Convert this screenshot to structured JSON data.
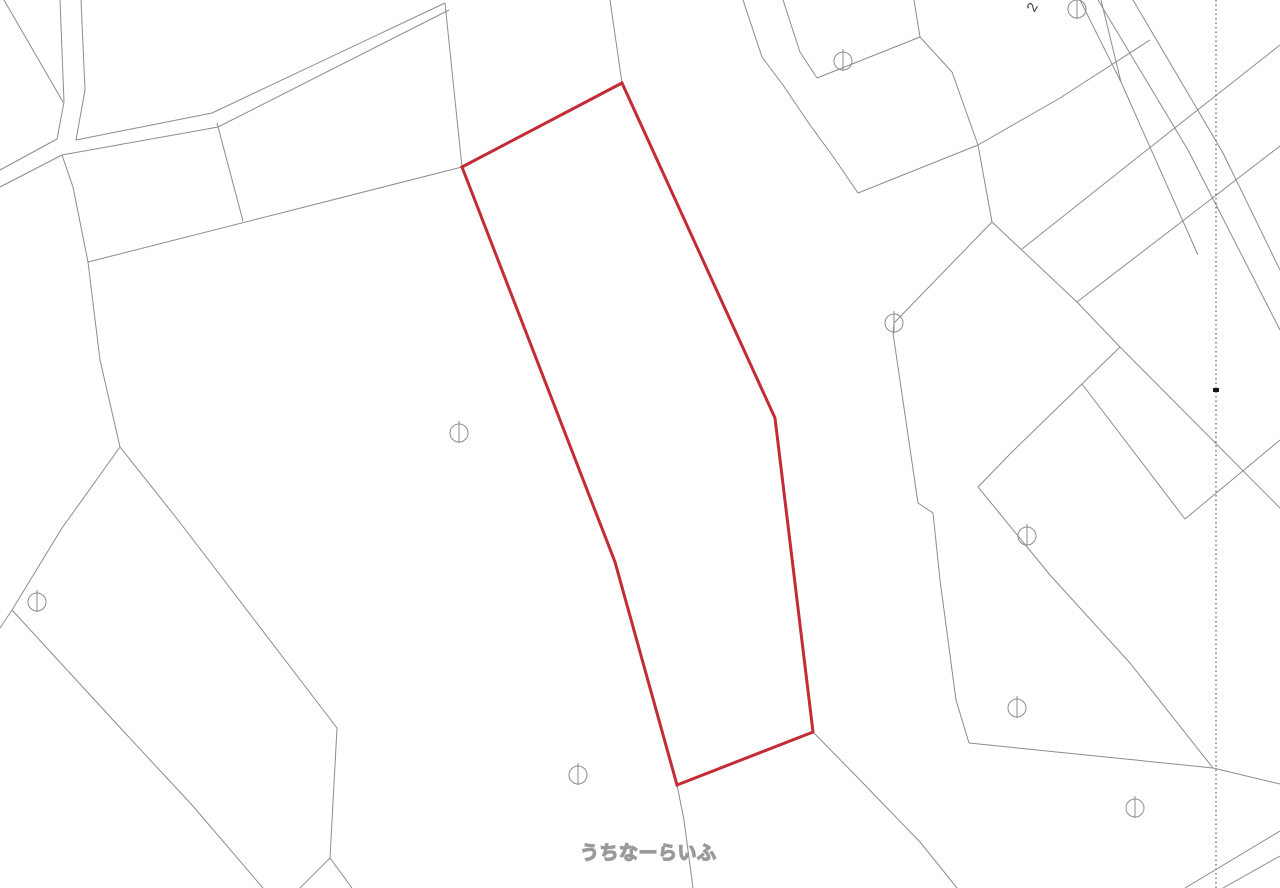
{
  "map": {
    "background_color": "#ffffff",
    "line_color": "#8c8c8c",
    "highlight_color": "#c32b35",
    "highlight_stroke_width": 3,
    "watermark": {
      "text": "うちなーらいふ",
      "x": 580,
      "y": 838
    },
    "parcel_number_label": {
      "text": "2",
      "x": 1028,
      "y": 0,
      "rotation": -62
    },
    "dotted_line": {
      "x": 1216,
      "y1": 0,
      "y2": 888,
      "color": "#5a5a5a"
    },
    "tick_marker": {
      "x": 1216,
      "y": 390,
      "color": "#1a1a1a"
    },
    "highlight_parcel": {
      "points": [
        [
          622,
          83
        ],
        [
          775,
          418
        ],
        [
          813,
          732
        ],
        [
          677,
          785
        ],
        [
          615,
          562
        ],
        [
          462,
          167
        ]
      ]
    },
    "boundary_lines": [
      [
        [
          4,
          0
        ],
        [
          63,
          102
        ]
      ],
      [
        [
          60,
          0
        ],
        [
          64,
          102
        ],
        [
          57,
          139
        ],
        [
          0,
          170
        ]
      ],
      [
        [
          81,
          0
        ],
        [
          85,
          90
        ],
        [
          76,
          140
        ],
        [
          212,
          113
        ],
        [
          445,
          3
        ]
      ],
      [
        [
          0,
          187
        ],
        [
          62,
          155
        ],
        [
          218,
          127
        ],
        [
          449,
          10
        ]
      ],
      [
        [
          62,
          155
        ],
        [
          73,
          187
        ],
        [
          88,
          262
        ]
      ],
      [
        [
          88,
          262
        ],
        [
          462,
          167
        ]
      ],
      [
        [
          217,
          123
        ],
        [
          243,
          221
        ]
      ],
      [
        [
          88,
          262
        ],
        [
          100,
          360
        ],
        [
          120,
          447
        ]
      ],
      [
        [
          120,
          447
        ],
        [
          62,
          528
        ],
        [
          12,
          610
        ],
        [
          0,
          628
        ]
      ],
      [
        [
          12,
          610
        ],
        [
          113,
          720
        ],
        [
          192,
          805
        ],
        [
          263,
          888
        ]
      ],
      [
        [
          120,
          447
        ],
        [
          178,
          520
        ],
        [
          337,
          728
        ],
        [
          330,
          858
        ]
      ],
      [
        [
          330,
          858
        ],
        [
          300,
          888
        ]
      ],
      [
        [
          330,
          858
        ],
        [
          352,
          888
        ]
      ],
      [
        [
          445,
          3
        ],
        [
          455,
          100
        ],
        [
          462,
          167
        ]
      ],
      [
        [
          610,
          0
        ],
        [
          622,
          83
        ]
      ],
      [
        [
          677,
          785
        ],
        [
          684,
          820
        ],
        [
          693,
          888
        ]
      ],
      [
        [
          813,
          732
        ],
        [
          860,
          780
        ],
        [
          920,
          842
        ],
        [
          957,
          888
        ]
      ],
      [
        [
          743,
          0
        ],
        [
          762,
          57
        ],
        [
          783,
          85
        ],
        [
          810,
          125
        ],
        [
          832,
          155
        ],
        [
          858,
          193
        ]
      ],
      [
        [
          783,
          0
        ],
        [
          800,
          52
        ],
        [
          817,
          78
        ]
      ],
      [
        [
          817,
          78
        ],
        [
          920,
          37
        ]
      ],
      [
        [
          914,
          0
        ],
        [
          920,
          37
        ],
        [
          952,
          72
        ],
        [
          978,
          145
        ],
        [
          992,
          222
        ]
      ],
      [
        [
          858,
          193
        ],
        [
          978,
          145
        ]
      ],
      [
        [
          978,
          145
        ],
        [
          1060,
          98
        ],
        [
          1150,
          40
        ]
      ],
      [
        [
          992,
          222
        ],
        [
          1077,
          302
        ],
        [
          1120,
          347
        ],
        [
          1280,
          508
        ]
      ],
      [
        [
          1022,
          249
        ],
        [
          1143,
          153
        ],
        [
          1280,
          45
        ]
      ],
      [
        [
          1077,
          302
        ],
        [
          1193,
          213
        ],
        [
          1280,
          146
        ]
      ],
      [
        [
          1120,
          347
        ],
        [
          1012,
          452
        ],
        [
          978,
          487
        ]
      ],
      [
        [
          978,
          487
        ],
        [
          1050,
          575
        ],
        [
          1130,
          663
        ],
        [
          1213,
          768
        ]
      ],
      [
        [
          1082,
          384
        ],
        [
          1185,
          519
        ],
        [
          1280,
          440
        ]
      ],
      [
        [
          1185,
          888
        ],
        [
          1280,
          831
        ]
      ],
      [
        [
          1223,
          888
        ],
        [
          1280,
          856
        ]
      ],
      [
        [
          969,
          743
        ],
        [
          1213,
          768
        ],
        [
          1280,
          784
        ]
      ],
      [
        [
          992,
          222
        ],
        [
          894,
          323
        ],
        [
          893,
          333
        ],
        [
          918,
          503
        ],
        [
          933,
          513
        ],
        [
          940,
          580
        ],
        [
          956,
          700
        ],
        [
          969,
          743
        ]
      ],
      [
        [
          1098,
          0
        ],
        [
          1188,
          150
        ],
        [
          1280,
          330
        ]
      ],
      [
        [
          1133,
          0
        ],
        [
          1223,
          153
        ],
        [
          1280,
          270
        ]
      ],
      [
        [
          1080,
          0
        ],
        [
          1121,
          82
        ]
      ],
      [
        [
          1101,
          0
        ],
        [
          1121,
          82
        ]
      ],
      [
        [
          1121,
          82
        ],
        [
          1198,
          255
        ]
      ]
    ],
    "survey_symbols": [
      {
        "x": 459,
        "y": 433
      },
      {
        "x": 37,
        "y": 602
      },
      {
        "x": 578,
        "y": 775
      },
      {
        "x": 843,
        "y": 61
      },
      {
        "x": 1077,
        "y": 9
      },
      {
        "x": 894,
        "y": 323
      },
      {
        "x": 1027,
        "y": 536
      },
      {
        "x": 1017,
        "y": 708
      },
      {
        "x": 1135,
        "y": 808
      }
    ],
    "symbol_radius": 9
  }
}
